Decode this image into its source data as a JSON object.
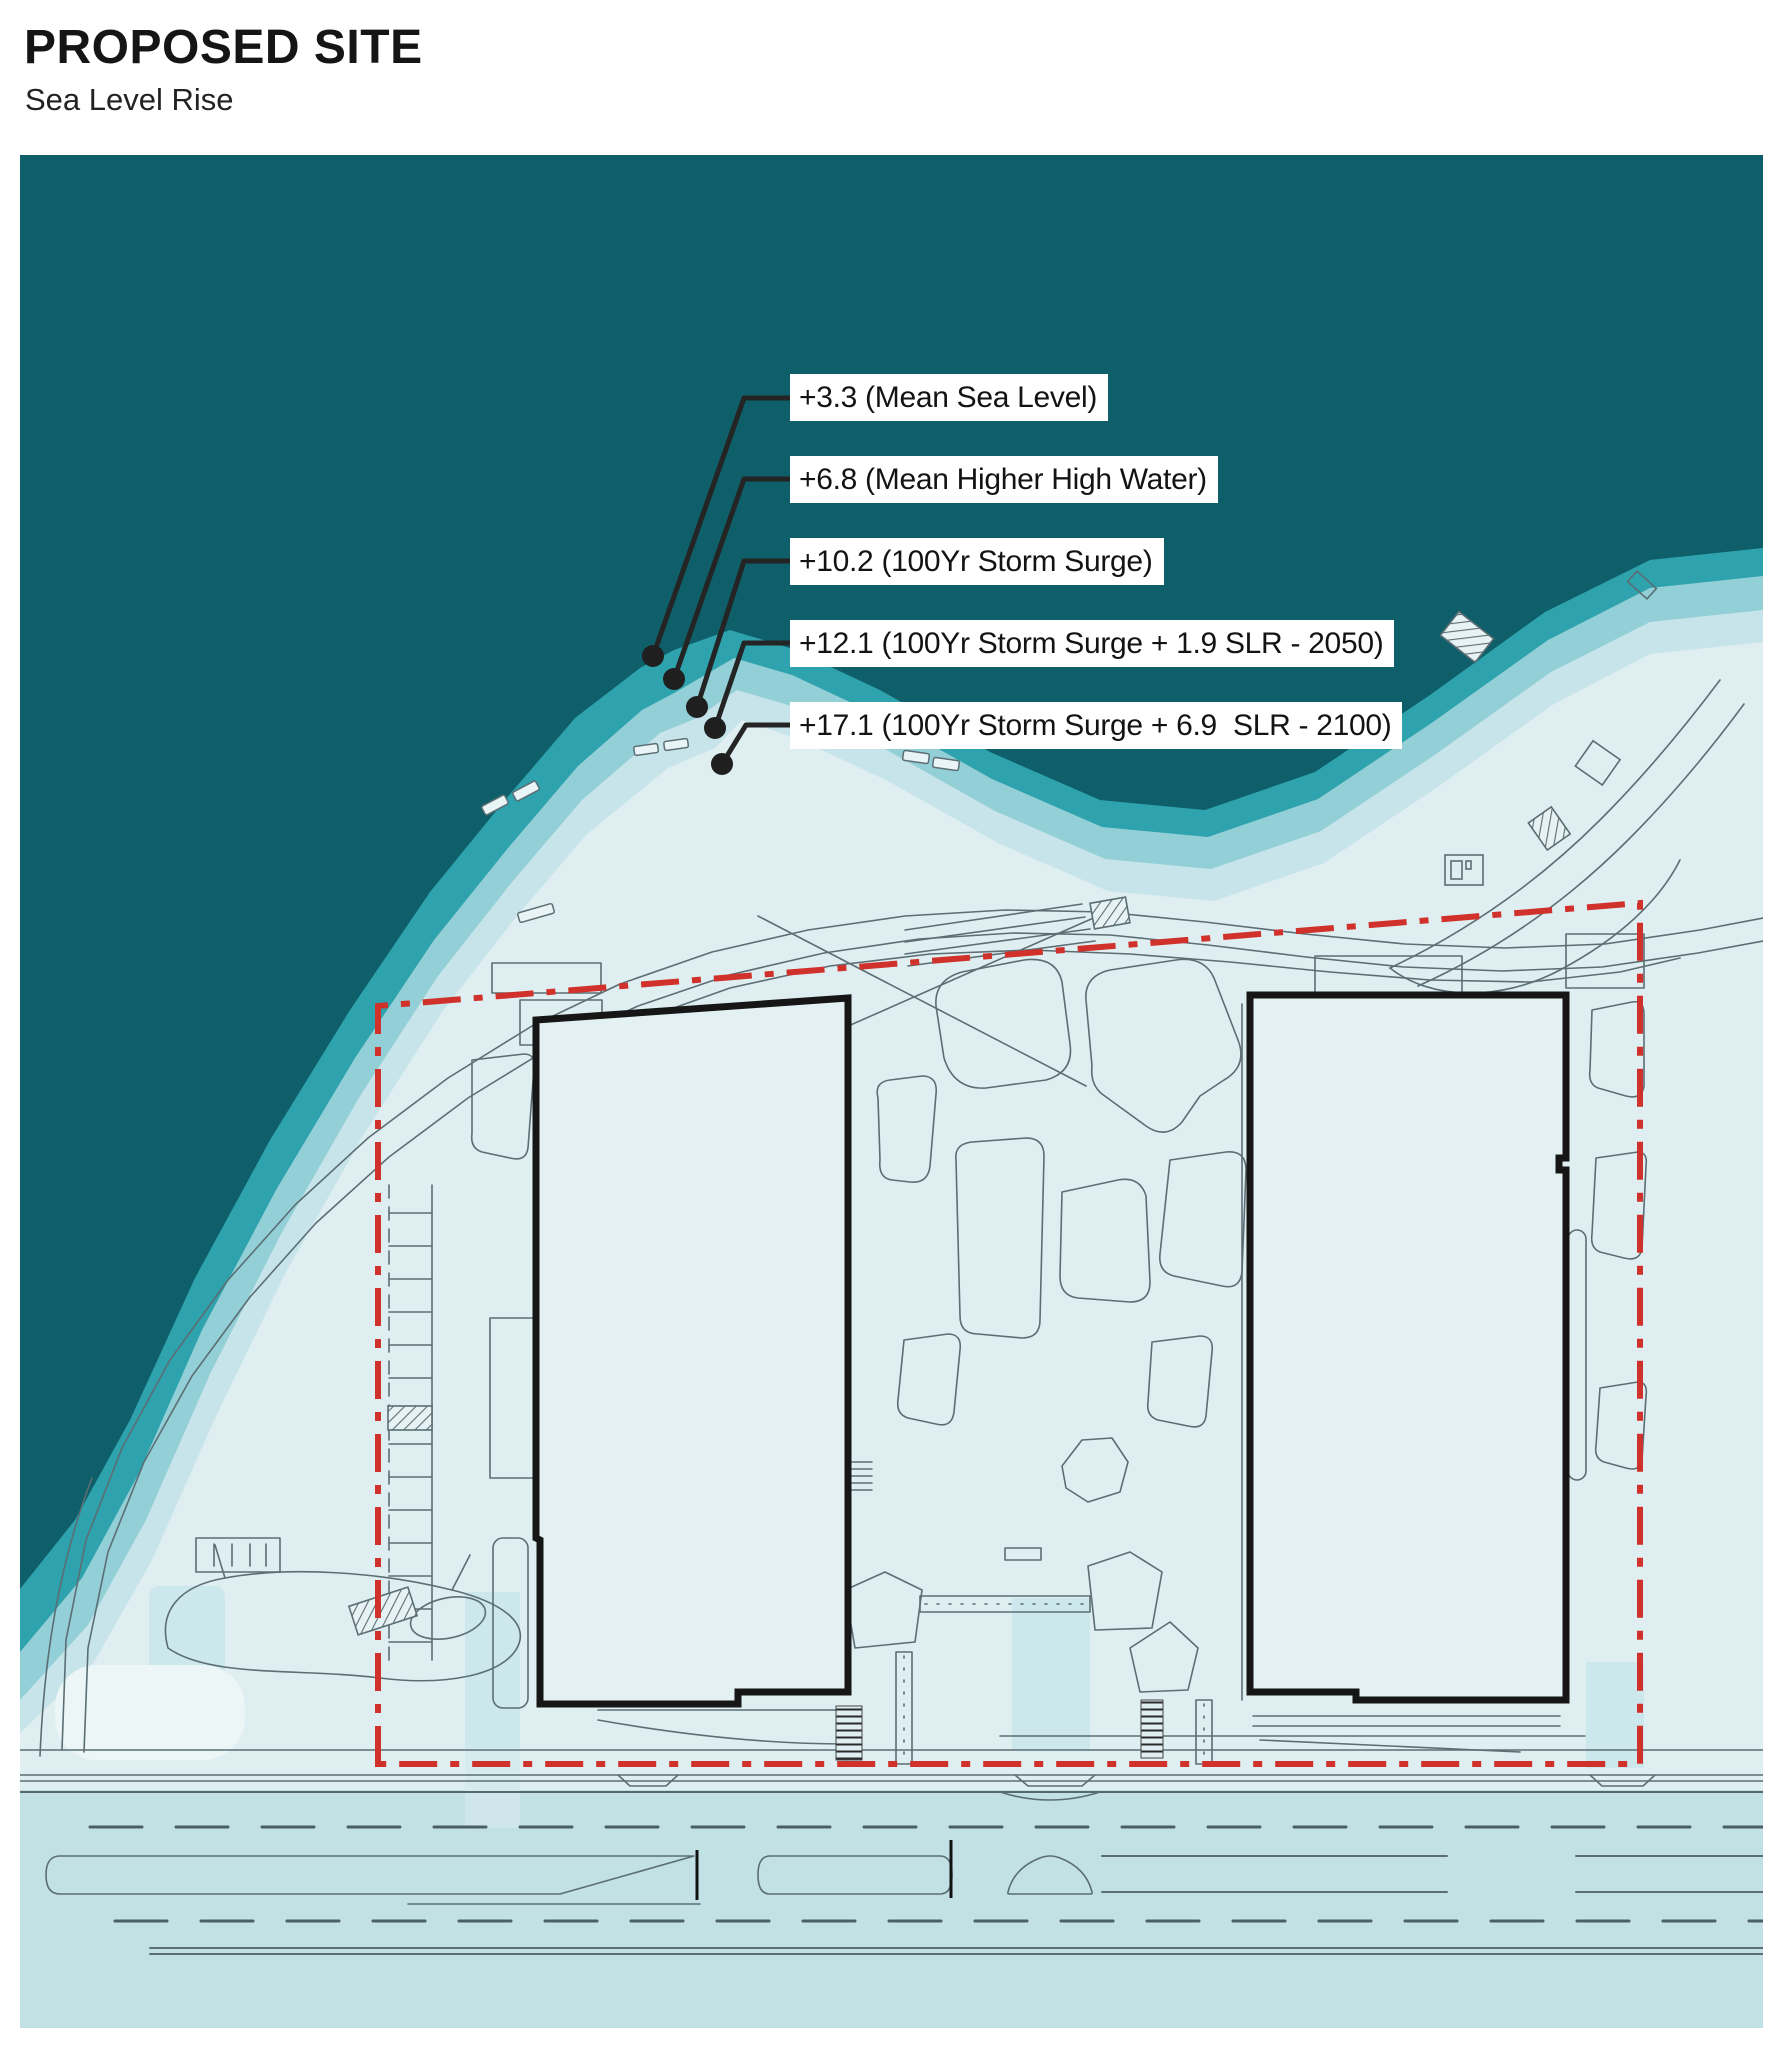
{
  "title": "PROPOSED SITE",
  "subtitle": "Sea Level Rise",
  "annotations": [
    {
      "label": "+3.3 (Mean Sea Level)",
      "elevation": "+3.3",
      "name": "Mean Sea Level"
    },
    {
      "label": "+6.8 (Mean Higher High Water)",
      "elevation": "+6.8",
      "name": "Mean Higher High Water"
    },
    {
      "label": "+10.2 (100Yr Storm Surge)",
      "elevation": "+10.2",
      "name": "100Yr Storm Surge"
    },
    {
      "label": "+12.1 (100Yr Storm Surge + 1.9 SLR - 2050)",
      "elevation": "+12.1",
      "name": "100Yr Storm Surge + 1.9 SLR - 2050"
    },
    {
      "label": "+17.1 (100Yr Storm Surge + 6.9  SLR - 2100)",
      "elevation": "+17.1",
      "name": "100Yr Storm Surge + 6.9 SLR - 2100"
    }
  ],
  "colors": {
    "water_mean_sea_level": "#0e5f69",
    "band_mean_higher_high_water": "#2ea2ad",
    "band_100yr_storm_surge": "#93cfd6",
    "band_storm_surge_2050": "#c6e4e9",
    "land_storm_surge_2100": "#dfeef1",
    "street": "#c2e1e4",
    "site_boundary": "#d0312a",
    "building_outline": "#161616",
    "leader_line": "#242424",
    "detail_line": "#5b6e74"
  },
  "map_features": {
    "water": "bay water (mean sea level)",
    "slr_bands": "nested shoreline inundation bands",
    "site_boundary": "red dash-dot property line",
    "buildings": [
      "west building footprint",
      "east building footprint"
    ],
    "street": "boulevard with lane striping and medians",
    "promenade": "waterfront promenade road"
  }
}
